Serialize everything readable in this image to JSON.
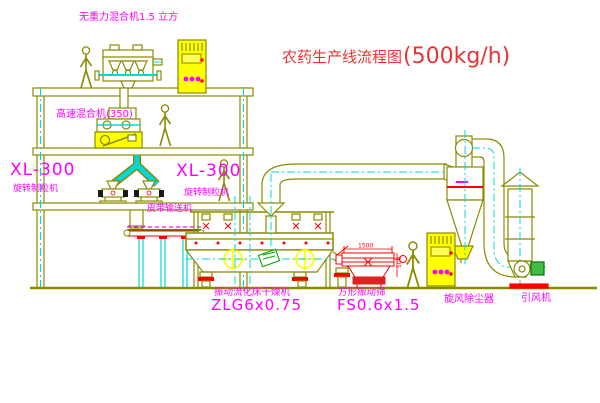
{
  "title": {
    "name": "农药生产线流程图",
    "capacity": "(500kg/h)"
  },
  "colors": {
    "background": "#ffffff",
    "machine_outline": "#8a8a00",
    "highlight_yellow": "#ffff00",
    "centerline_cyan": "#00d8d8",
    "label_magenta": "#ff00ff",
    "title_red": "#e83434",
    "accent_red": "#ff0000",
    "accent_green": "#00aa00"
  },
  "equipment": {
    "gravity_mixer": {
      "label": "无重力混合机1.5 立方"
    },
    "high_speed_mixer": {
      "label": "高速混合机(350)"
    },
    "granulator_left": {
      "model": "XL-300",
      "label": "旋转制粒机"
    },
    "granulator_right": {
      "model": "XL-300",
      "label": "旋转制粒机"
    },
    "belt_conveyor": {
      "label": "皮带输送机"
    },
    "dryer": {
      "label": "振动流化床干燥机",
      "model": "ZLG6x0.75"
    },
    "sieve": {
      "label": "方形振动筛",
      "model": "FS0.6x1.5",
      "dim_length": "1500",
      "dim_height": "500"
    },
    "cyclone": {
      "label": "旋风除尘器"
    },
    "fan": {
      "label": "引风机"
    }
  }
}
